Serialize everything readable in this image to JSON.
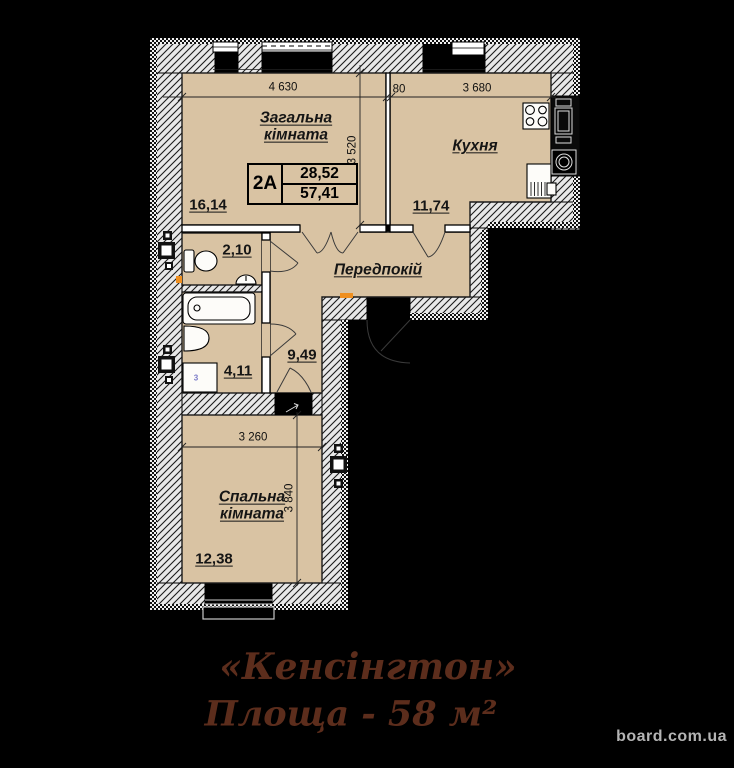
{
  "plan": {
    "unit_table": {
      "unit": "2A",
      "upper": "28,52",
      "lower": "57,41"
    },
    "rooms": {
      "living": {
        "name": "Загальна кімната",
        "area": "16,14"
      },
      "kitchen": {
        "name": "Кухня",
        "area": "11,74"
      },
      "hall": {
        "name": "Передпокій",
        "area": "9,49"
      },
      "wc": {
        "area": "2,10"
      },
      "bath": {
        "area": "4,11"
      },
      "bedroom": {
        "name": "Спальна кімната",
        "area": "12,38"
      }
    },
    "dimensions": {
      "living_width": "4 630",
      "wall": "80",
      "kitchen_width": "3 680",
      "living_depth": "3 520",
      "bedroom_width": "3 260",
      "bedroom_depth": "3 840"
    },
    "washer_label": "3",
    "colors": {
      "room_fill": "#d9c3a3",
      "wall_hatch_bg": "#e8e8e8",
      "line": "#000000",
      "accent_orange": "#ef8f1f",
      "washer_digit": "#7a7ac8"
    }
  },
  "title_block": {
    "name": "«Кенсінгтон»",
    "area_line": "Площа - 58 м²",
    "color": "#5c2d1c"
  },
  "watermark": {
    "text": "board.com.ua",
    "color": "#b4b4b4"
  }
}
